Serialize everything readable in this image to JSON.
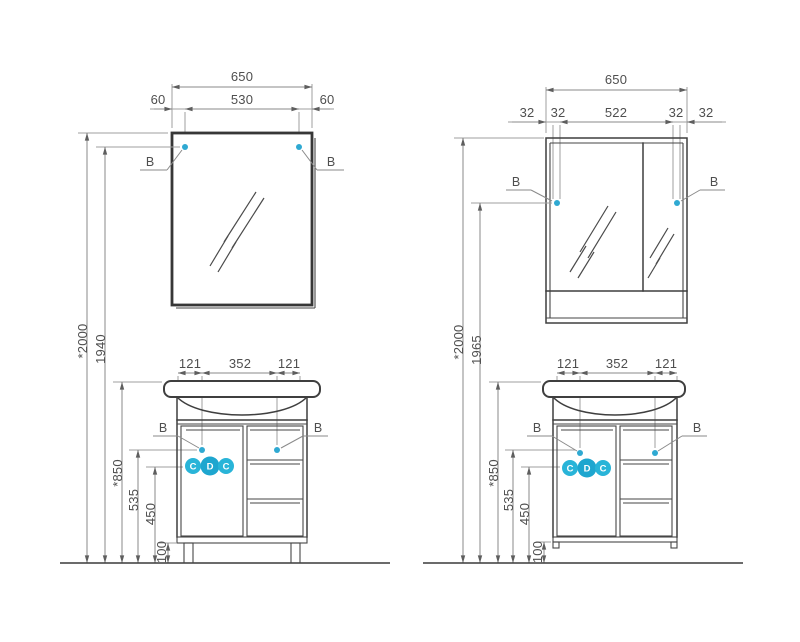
{
  "title": "Bathroom furniture installation drawing",
  "colors": {
    "accent_cyan": "#29b4d8",
    "line_dark": "#3f3f3f",
    "line_dim": "#9f9f9f",
    "text": "#4f4f4f"
  },
  "left_view": {
    "mirror_dims": {
      "total": "650",
      "left": "60",
      "center": "530",
      "right": "60"
    },
    "mount_label_left": "B",
    "mount_label_right": "B",
    "heights": {
      "overall": "*2000",
      "mirror_mount": "1940",
      "basin": "*850",
      "vanity_mount": "535",
      "siphon": "450",
      "legs": "100"
    },
    "vanity_dims": {
      "left": "121",
      "center": "352",
      "right": "121"
    },
    "vanity_mount_label_left": "B",
    "vanity_mount_label_right": "B",
    "connections": [
      "C",
      "D",
      "C"
    ]
  },
  "right_view": {
    "mirror_dims": {
      "total": "650",
      "far_left": "32",
      "inner_left": "32",
      "center": "522",
      "inner_right": "32",
      "far_right": "32"
    },
    "mount_label_left": "B",
    "mount_label_right": "B",
    "heights": {
      "overall": "*2000",
      "mirror_mount": "1965",
      "basin": "*850",
      "vanity_mount": "535",
      "siphon": "450",
      "legs": "100"
    },
    "vanity_dims": {
      "left": "121",
      "center": "352",
      "right": "121"
    },
    "vanity_mount_label_left": "B",
    "vanity_mount_label_right": "B",
    "connections": [
      "C",
      "D",
      "C"
    ]
  }
}
